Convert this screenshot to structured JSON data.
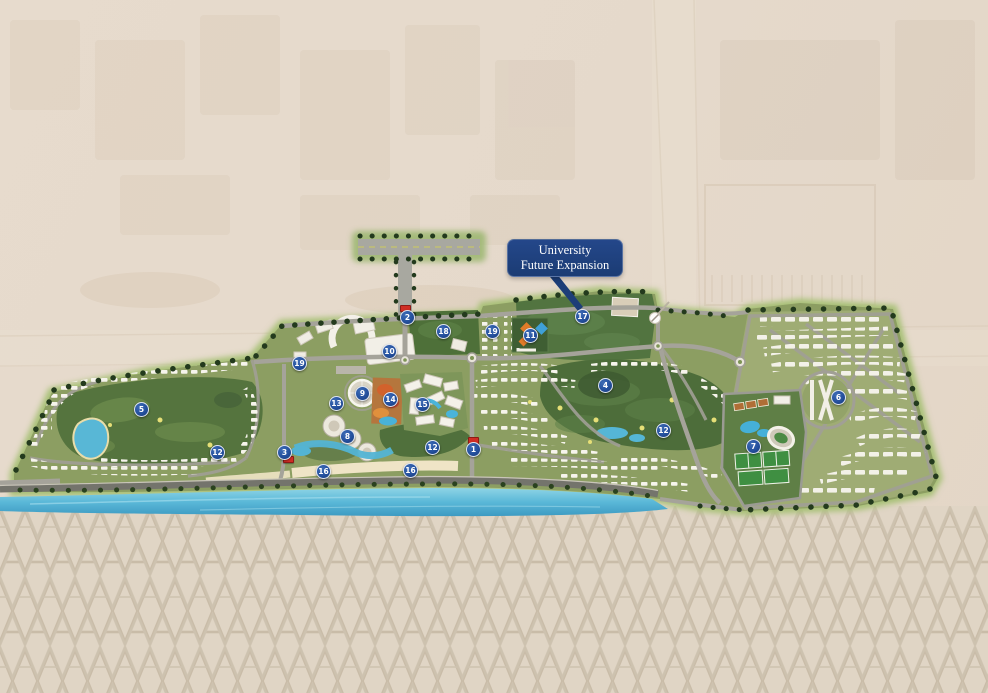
{
  "callout": {
    "line1": "University",
    "line2": "Future Expansion"
  },
  "colors": {
    "callout_bg": "#1d3e78",
    "marker_blue": "#24509e",
    "entrance_red": "#cf2d24",
    "sea_blue": "#55b6d6",
    "desert_beige": "#e5d9cb",
    "pattern_beige": "#e0d5c5",
    "pattern_glyph": "#c9bca8",
    "golf_green": "#55743e",
    "residential_olive": "#8c9e62"
  },
  "markers": [
    {
      "label": "1",
      "x": 473,
      "y": 449
    },
    {
      "label": "2",
      "x": 407,
      "y": 317
    },
    {
      "label": "3",
      "x": 284,
      "y": 452
    },
    {
      "label": "4",
      "x": 605,
      "y": 385
    },
    {
      "label": "5",
      "x": 141,
      "y": 409
    },
    {
      "label": "6",
      "x": 838,
      "y": 397
    },
    {
      "label": "7",
      "x": 753,
      "y": 446
    },
    {
      "label": "8",
      "x": 347,
      "y": 436
    },
    {
      "label": "9",
      "x": 362,
      "y": 393
    },
    {
      "label": "10",
      "x": 389,
      "y": 351
    },
    {
      "label": "11",
      "x": 530,
      "y": 335
    },
    {
      "label": "12",
      "x": 217,
      "y": 452
    },
    {
      "label": "12",
      "x": 432,
      "y": 447
    },
    {
      "label": "12",
      "x": 663,
      "y": 430
    },
    {
      "label": "13",
      "x": 336,
      "y": 403
    },
    {
      "label": "14",
      "x": 390,
      "y": 399
    },
    {
      "label": "15",
      "x": 422,
      "y": 404
    },
    {
      "label": "16",
      "x": 323,
      "y": 471
    },
    {
      "label": "16",
      "x": 410,
      "y": 470
    },
    {
      "label": "17",
      "x": 582,
      "y": 316
    },
    {
      "label": "18",
      "x": 443,
      "y": 331
    },
    {
      "label": "19",
      "x": 299,
      "y": 363
    },
    {
      "label": "19",
      "x": 492,
      "y": 331
    }
  ],
  "entrance_gates": [
    {
      "x": 473,
      "y": 440
    },
    {
      "x": 405,
      "y": 308
    },
    {
      "x": 288,
      "y": 459
    }
  ]
}
